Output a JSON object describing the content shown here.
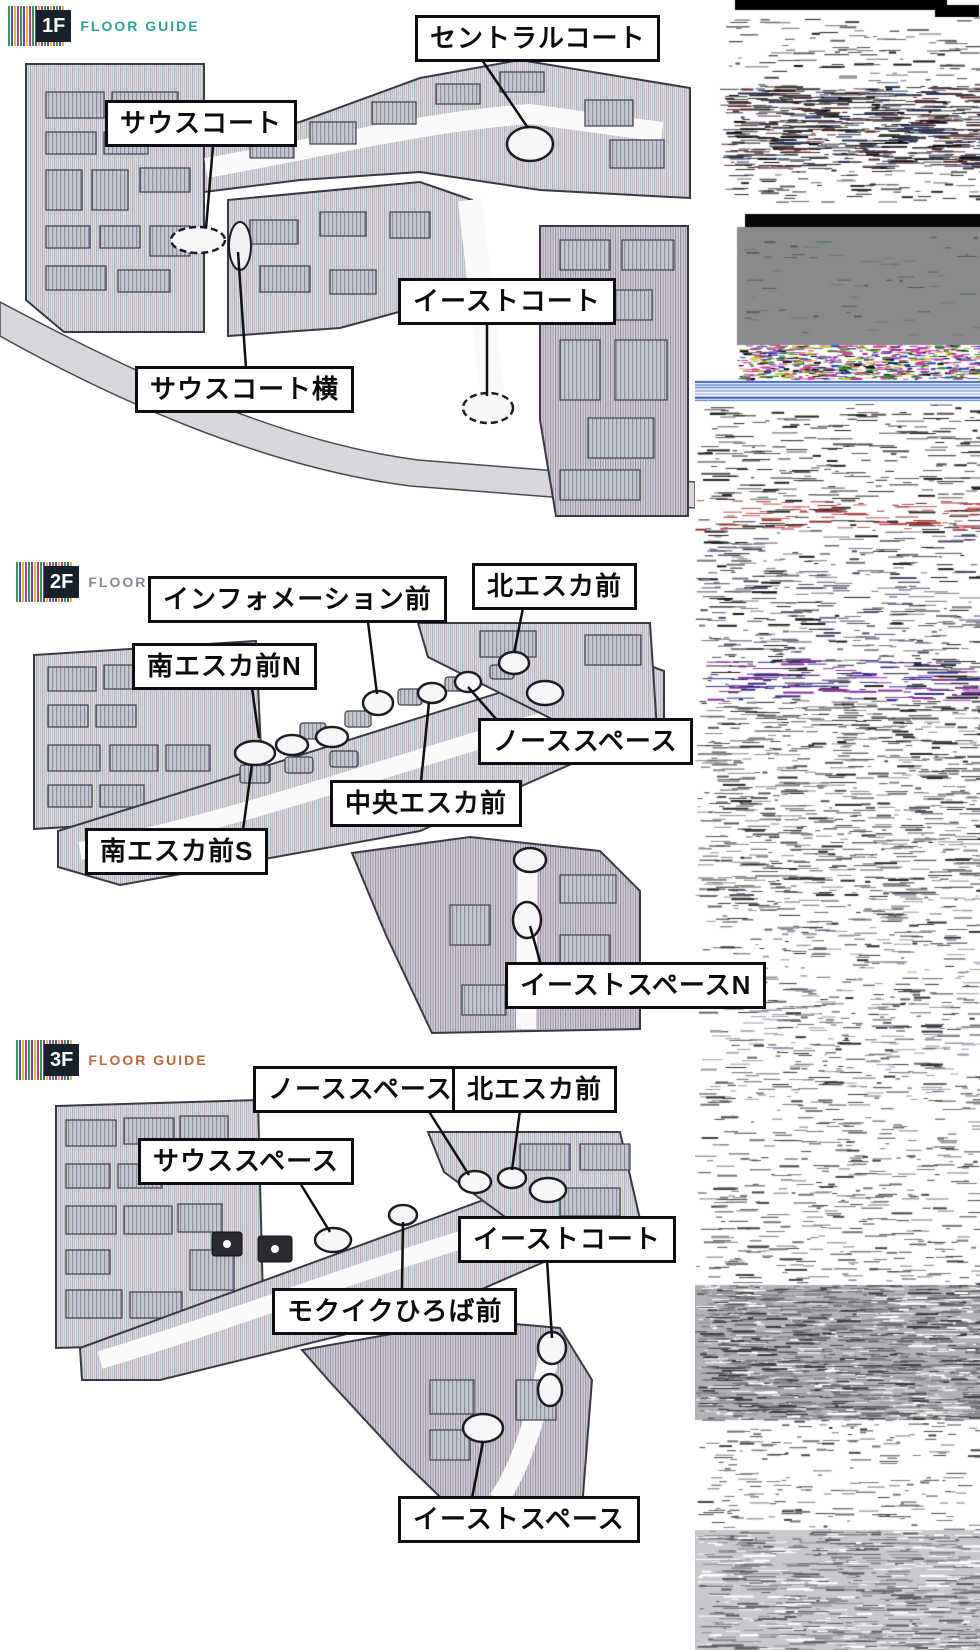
{
  "page": {
    "background": "#ffffff"
  },
  "floors": [
    {
      "header": {
        "floor": "1F",
        "guide": "FLOOR GUIDE",
        "guide_color": "#2fa394"
      },
      "labels": [
        {
          "id": "central-court",
          "text": "セントラルコート"
        },
        {
          "id": "south-court",
          "text": "サウスコート"
        },
        {
          "id": "east-court",
          "text": "イーストコート"
        },
        {
          "id": "south-court-side",
          "text": "サウスコート横"
        }
      ]
    },
    {
      "header": {
        "floor": "2F",
        "guide": "FLOOR GUIDE",
        "guide_color": "#8d8498"
      },
      "labels": [
        {
          "id": "information-front",
          "text": "インフォメーション前"
        },
        {
          "id": "north-escalator-front",
          "text": "北エスカ前"
        },
        {
          "id": "south-escalator-front-n",
          "text": "南エスカ前N"
        },
        {
          "id": "north-space",
          "text": "ノーススペース"
        },
        {
          "id": "central-escalator-front",
          "text": "中央エスカ前"
        },
        {
          "id": "south-escalator-front-s",
          "text": "南エスカ前S"
        },
        {
          "id": "east-space-n",
          "text": "イーストスペースN"
        }
      ]
    },
    {
      "header": {
        "floor": "3F",
        "guide": "FLOOR GUIDE",
        "guide_color": "#c2663a"
      },
      "labels": [
        {
          "id": "north-space",
          "text": "ノーススペース"
        },
        {
          "id": "north-escalator-front",
          "text": "北エスカ前"
        },
        {
          "id": "south-space",
          "text": "サウススペース"
        },
        {
          "id": "east-court",
          "text": "イーストコート"
        },
        {
          "id": "mokuiku-hiroba-front",
          "text": "モクイクひろば前"
        },
        {
          "id": "east-space",
          "text": "イーストスペース"
        }
      ]
    }
  ],
  "side_panel": {
    "type": "corrupted-scan-noise",
    "bands": [
      {
        "kind": "bar",
        "x": 40,
        "y": 0,
        "w": 212,
        "h": 10,
        "color": "#000000"
      },
      {
        "kind": "bar",
        "x": 240,
        "y": 5,
        "w": 44,
        "h": 12,
        "color": "#000000"
      },
      {
        "kind": "noise",
        "y": 16,
        "h": 70,
        "x0": 30,
        "density": 0.035,
        "colors": [
          "#1a1a1a",
          "#4a4a4a",
          "#6a6a6a"
        ],
        "maxLen": 22
      },
      {
        "kind": "noise",
        "y": 86,
        "h": 82,
        "x0": 25,
        "density": 0.17,
        "colors": [
          "#0c0c0c",
          "#2e2e2e",
          "#5c2828",
          "#28345c",
          "#3c3c3c"
        ],
        "maxLen": 30
      },
      {
        "kind": "noise",
        "y": 168,
        "h": 34,
        "x0": 25,
        "density": 0.05,
        "colors": [
          "#2a2a2a",
          "#666666"
        ],
        "maxLen": 18
      },
      {
        "kind": "bar",
        "x": 50,
        "y": 214,
        "w": 235,
        "h": 13,
        "color": "#060606"
      },
      {
        "kind": "bar",
        "x": 42,
        "y": 227,
        "w": 243,
        "h": 118,
        "color": "#8b8b8d"
      },
      {
        "kind": "noise",
        "y": 235,
        "h": 100,
        "x0": 42,
        "density": 0.015,
        "colors": [
          "#5a5a5a",
          "#6f796f"
        ],
        "maxLen": 14
      },
      {
        "kind": "noise",
        "y": 345,
        "h": 34,
        "x0": 42,
        "density": 0.5,
        "colors": [
          "#b428b4",
          "#2844c0",
          "#d84090",
          "#101010",
          "#2a8a2a",
          "#c8c828"
        ],
        "maxLen": 8
      },
      {
        "kind": "lines",
        "y": 381,
        "h": 22,
        "colors": [
          "#3a66c8",
          "#7a9ad8",
          "#2a50b0"
        ],
        "count": 7
      },
      {
        "kind": "noise",
        "y": 404,
        "h": 96,
        "density": 0.05,
        "colors": [
          "#222222",
          "#555555"
        ],
        "maxLen": 26
      },
      {
        "kind": "noise",
        "y": 500,
        "h": 30,
        "density": 0.09,
        "colors": [
          "#9a3030",
          "#c05050",
          "#303030"
        ],
        "maxLen": 26
      },
      {
        "kind": "noise",
        "y": 530,
        "h": 130,
        "density": 0.06,
        "colors": [
          "#1a1a1a",
          "#4a4a6a",
          "#777777"
        ],
        "maxLen": 24
      },
      {
        "kind": "noise",
        "y": 660,
        "h": 40,
        "density": 0.1,
        "colors": [
          "#8a30a0",
          "#30308a",
          "#222222"
        ],
        "maxLen": 30
      },
      {
        "kind": "noise",
        "y": 700,
        "h": 200,
        "density": 0.08,
        "colors": [
          "#2a2a2a",
          "#55555f",
          "#888888"
        ],
        "maxLen": 24
      },
      {
        "kind": "noise",
        "y": 900,
        "h": 200,
        "density": 0.06,
        "colors": [
          "#333333",
          "#666666",
          "#9999aa"
        ],
        "maxLen": 20
      },
      {
        "kind": "noise",
        "y": 1100,
        "h": 185,
        "density": 0.045,
        "colors": [
          "#444444",
          "#777777"
        ],
        "maxLen": 20
      },
      {
        "kind": "bar",
        "x": 0,
        "y": 1285,
        "w": 285,
        "h": 135,
        "color": "#b2b2b6"
      },
      {
        "kind": "noise",
        "y": 1285,
        "h": 135,
        "density": 0.22,
        "colors": [
          "#3a3a3e",
          "#6a6a70",
          "#ffffff",
          "#8a8a90"
        ],
        "maxLen": 26
      },
      {
        "kind": "noise",
        "y": 1420,
        "h": 110,
        "density": 0.04,
        "colors": [
          "#444444",
          "#777777"
        ],
        "maxLen": 18
      },
      {
        "kind": "bar",
        "x": 0,
        "y": 1530,
        "w": 285,
        "h": 120,
        "color": "#c9c9cd"
      },
      {
        "kind": "noise",
        "y": 1530,
        "h": 120,
        "density": 0.12,
        "colors": [
          "#8a8a90",
          "#ffffff",
          "#5a5a60"
        ],
        "maxLen": 30
      }
    ]
  }
}
